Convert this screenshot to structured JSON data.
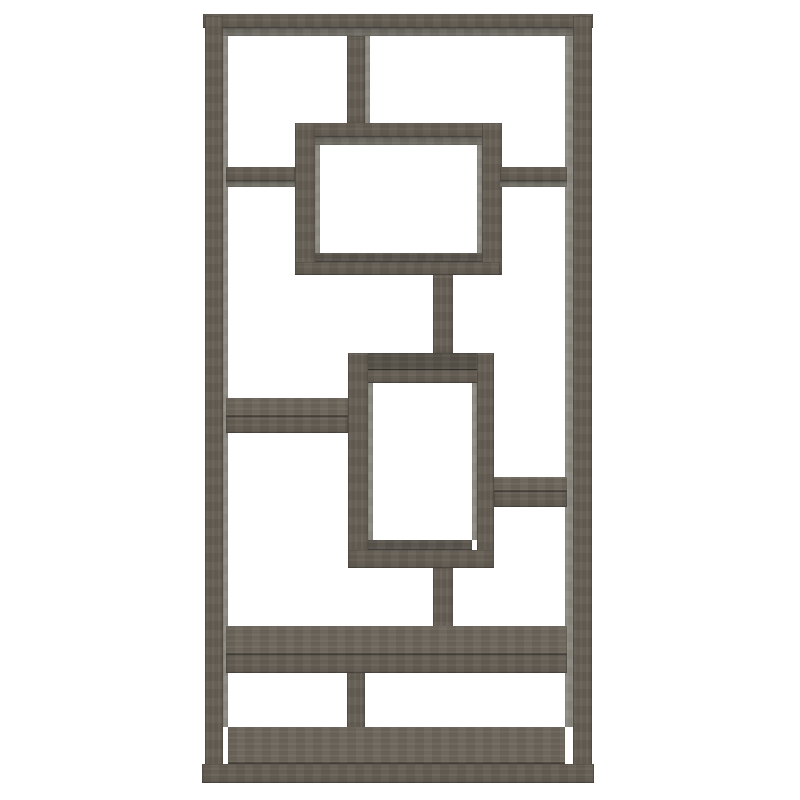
{
  "scene": {
    "description": "Product photo of a tall geometric 10-shelf bookcase in weathered grey wood, interlocking rectangular openings, on a plain white background",
    "background_color": "#ffffff"
  },
  "palette": {
    "wood": "#665f55",
    "wood_top": "#6e675c",
    "wood_top_dark": "#58534a",
    "inner_face": "#8d8b82",
    "underside": "#6f6d64",
    "interior_shadow": "#5b564e"
  },
  "bookcase": {
    "outer_bounds": {
      "left": 202,
      "top": 14,
      "right": 594,
      "bottom": 783
    },
    "pieces": [
      {
        "name": "top-rail-front",
        "x": 203,
        "y": 14,
        "w": 390,
        "h": 14,
        "kind": "front",
        "grain": "h"
      },
      {
        "name": "top-rail-underside",
        "x": 209,
        "y": 28,
        "w": 378,
        "h": 8,
        "kind": "under",
        "grain": "h"
      },
      {
        "name": "left-post-front",
        "x": 205,
        "y": 16,
        "w": 18,
        "h": 767,
        "kind": "front",
        "grain": "v"
      },
      {
        "name": "left-post-inner-face",
        "x": 223,
        "y": 36,
        "w": 5,
        "h": 691,
        "kind": "inner",
        "grain": "v"
      },
      {
        "name": "right-post-inner-face",
        "x": 565,
        "y": 36,
        "w": 8,
        "h": 691,
        "kind": "inner",
        "grain": "v"
      },
      {
        "name": "right-post-front",
        "x": 573,
        "y": 16,
        "w": 19,
        "h": 767,
        "kind": "front",
        "grain": "v"
      },
      {
        "name": "top-divider-front",
        "x": 347,
        "y": 36,
        "w": 18,
        "h": 89,
        "kind": "front",
        "grain": "v"
      },
      {
        "name": "top-divider-inner-face",
        "x": 365,
        "y": 36,
        "w": 5,
        "h": 87,
        "kind": "inner",
        "grain": "v"
      },
      {
        "name": "upper-box-top-front",
        "x": 295,
        "y": 123,
        "w": 205,
        "h": 14,
        "kind": "front",
        "grain": "h"
      },
      {
        "name": "upper-box-top-underside",
        "x": 315,
        "y": 137,
        "w": 167,
        "h": 8,
        "kind": "under",
        "grain": "h"
      },
      {
        "name": "upper-box-left-wall",
        "x": 295,
        "y": 123,
        "w": 20,
        "h": 152,
        "kind": "front",
        "grain": "v"
      },
      {
        "name": "upper-box-left-inner-face",
        "x": 315,
        "y": 145,
        "w": 5,
        "h": 108,
        "kind": "inner",
        "grain": "v"
      },
      {
        "name": "upper-box-right-inner-face",
        "x": 477,
        "y": 145,
        "w": 5,
        "h": 108,
        "kind": "inner",
        "grain": "v"
      },
      {
        "name": "upper-box-right-wall",
        "x": 482,
        "y": 123,
        "w": 20,
        "h": 152,
        "kind": "front",
        "grain": "v"
      },
      {
        "name": "upper-box-bottom-shadow",
        "x": 315,
        "y": 253,
        "w": 167,
        "h": 9,
        "kind": "shadow",
        "grain": "h"
      },
      {
        "name": "upper-box-bottom-front",
        "x": 295,
        "y": 262,
        "w": 205,
        "h": 13,
        "kind": "front",
        "grain": "h"
      },
      {
        "name": "upper-left-shelf-front",
        "x": 226,
        "y": 167,
        "w": 69,
        "h": 14,
        "kind": "front",
        "grain": "h"
      },
      {
        "name": "upper-left-shelf-underside",
        "x": 226,
        "y": 181,
        "w": 69,
        "h": 6,
        "kind": "under",
        "grain": "h"
      },
      {
        "name": "upper-right-shelf-front",
        "x": 500,
        "y": 167,
        "w": 67,
        "h": 14,
        "kind": "front",
        "grain": "h"
      },
      {
        "name": "upper-right-shelf-underside",
        "x": 500,
        "y": 181,
        "w": 67,
        "h": 6,
        "kind": "under",
        "grain": "h"
      },
      {
        "name": "upper-stem-front",
        "x": 433,
        "y": 275,
        "w": 20,
        "h": 80,
        "kind": "front",
        "grain": "v"
      },
      {
        "name": "middle-box-top-surface",
        "x": 348,
        "y": 353,
        "w": 146,
        "h": 17,
        "kind": "topdark",
        "grain": "h"
      },
      {
        "name": "middle-box-top-front",
        "x": 348,
        "y": 370,
        "w": 146,
        "h": 13,
        "kind": "front",
        "grain": "h"
      },
      {
        "name": "middle-box-left-wall",
        "x": 348,
        "y": 353,
        "w": 20,
        "h": 215,
        "kind": "front",
        "grain": "v"
      },
      {
        "name": "middle-box-left-inner-face",
        "x": 368,
        "y": 383,
        "w": 5,
        "h": 157,
        "kind": "inner",
        "grain": "v"
      },
      {
        "name": "middle-box-right-inner-face",
        "x": 472,
        "y": 383,
        "w": 5,
        "h": 157,
        "kind": "inner",
        "grain": "v"
      },
      {
        "name": "middle-box-right-wall",
        "x": 477,
        "y": 353,
        "w": 17,
        "h": 215,
        "kind": "front",
        "grain": "v"
      },
      {
        "name": "middle-box-bottom-shadow",
        "x": 368,
        "y": 540,
        "w": 104,
        "h": 10,
        "kind": "shadow",
        "grain": "h"
      },
      {
        "name": "middle-box-bottom-front",
        "x": 348,
        "y": 550,
        "w": 146,
        "h": 18,
        "kind": "front",
        "grain": "h"
      },
      {
        "name": "mid-left-shelf-top",
        "x": 226,
        "y": 398,
        "w": 122,
        "h": 19,
        "kind": "top",
        "grain": "h"
      },
      {
        "name": "mid-left-shelf-front",
        "x": 226,
        "y": 417,
        "w": 122,
        "h": 16,
        "kind": "front",
        "grain": "h"
      },
      {
        "name": "mid-right-shelf-top",
        "x": 494,
        "y": 477,
        "w": 73,
        "h": 15,
        "kind": "top",
        "grain": "h"
      },
      {
        "name": "mid-right-shelf-front",
        "x": 494,
        "y": 492,
        "w": 73,
        "h": 15,
        "kind": "front",
        "grain": "h"
      },
      {
        "name": "lower-stem-front",
        "x": 433,
        "y": 568,
        "w": 20,
        "h": 88,
        "kind": "front",
        "grain": "v"
      },
      {
        "name": "lower-shelf-top",
        "x": 226,
        "y": 626,
        "w": 341,
        "h": 29,
        "kind": "top",
        "grain": "h"
      },
      {
        "name": "lower-shelf-front",
        "x": 226,
        "y": 655,
        "w": 341,
        "h": 18,
        "kind": "front",
        "grain": "h"
      },
      {
        "name": "bottom-divider-front",
        "x": 347,
        "y": 673,
        "w": 18,
        "h": 92,
        "kind": "front",
        "grain": "v"
      },
      {
        "name": "floor-top-surface",
        "x": 228,
        "y": 727,
        "w": 337,
        "h": 37,
        "kind": "top",
        "grain": "h"
      },
      {
        "name": "plinth-front",
        "x": 202,
        "y": 764,
        "w": 392,
        "h": 19,
        "kind": "front",
        "grain": "h"
      }
    ]
  }
}
